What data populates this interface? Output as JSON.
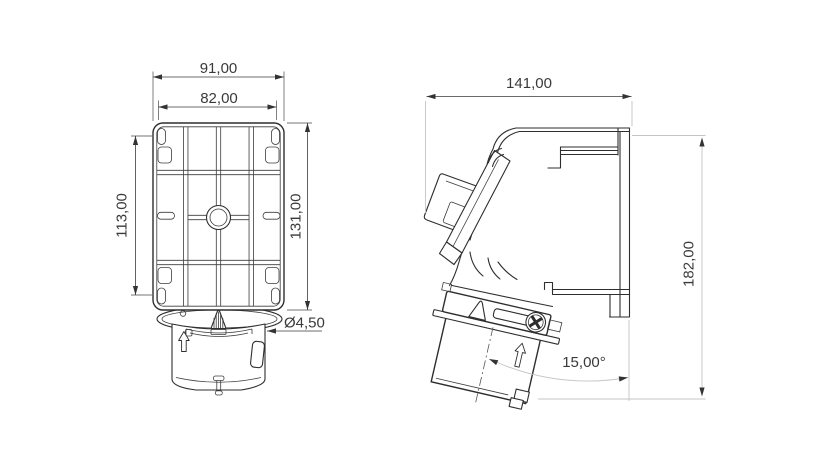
{
  "drawing": {
    "type": "technical-dimension-drawing",
    "background": "#ffffff",
    "line_color": "#2e2e2e",
    "dim_color": "#3a3a3a",
    "ext_color": "#c4c4c4",
    "front_view": {
      "name": "rear-mounting-plate-view",
      "dims": {
        "outer_width": "91,00",
        "inner_width": "82,00",
        "inner_height": "113,00",
        "outer_height": "131,00",
        "hole_diameter": "Ø4,50"
      }
    },
    "side_view": {
      "name": "side-profile-view",
      "dims": {
        "depth": "141,00",
        "height": "182,00",
        "socket_angle": "15,00°"
      }
    },
    "icons": {
      "screw": "phillips-screw-icon",
      "front_arrow": "up-arrow-icon",
      "side_arrow": "up-arrow-icon"
    }
  }
}
